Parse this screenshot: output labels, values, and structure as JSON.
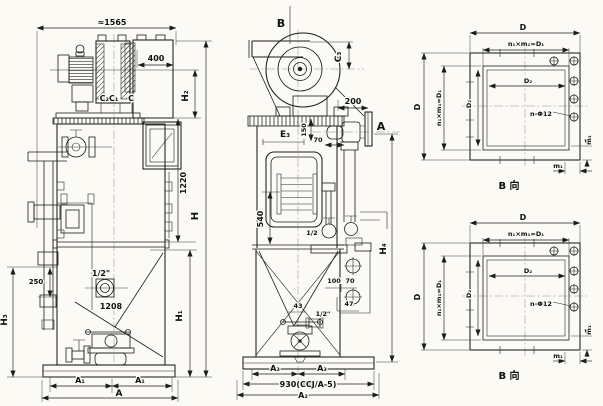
{
  "front": {
    "overall_width": "≈1565",
    "fan_depth": "400",
    "c2c1": "C₂C₁",
    "c": "C",
    "h2": "H₂",
    "v1220": "1220",
    "h": "H",
    "d250": "250",
    "half_inch": "1/2\"",
    "d1208": "1208",
    "h3": "H₃",
    "h1": "H₁",
    "a1": "A₁",
    "a": "A"
  },
  "side": {
    "b": "B",
    "c3": "C₃",
    "d200": "200",
    "a": "A",
    "e3": "E₃",
    "d150": "150",
    "d70a": "70",
    "d540": "540",
    "half": "1/2",
    "h4": "H₄",
    "d100": "100",
    "d70b": "70",
    "d43": "43",
    "d47": "47",
    "half_inch": "1/2\"",
    "a3": "A₃",
    "base_model": "930(CCJ/A-5)",
    "a2": "A₂"
  },
  "flange": {
    "d": "D",
    "bolt_row": "n₁×m₁=D₁",
    "d2": "D₂",
    "holes": "n-Φ12",
    "m1": "m₁",
    "caption": "B 向"
  },
  "colors": {
    "paper": "#fbfaf5",
    "ink": "#1c1c1c"
  }
}
